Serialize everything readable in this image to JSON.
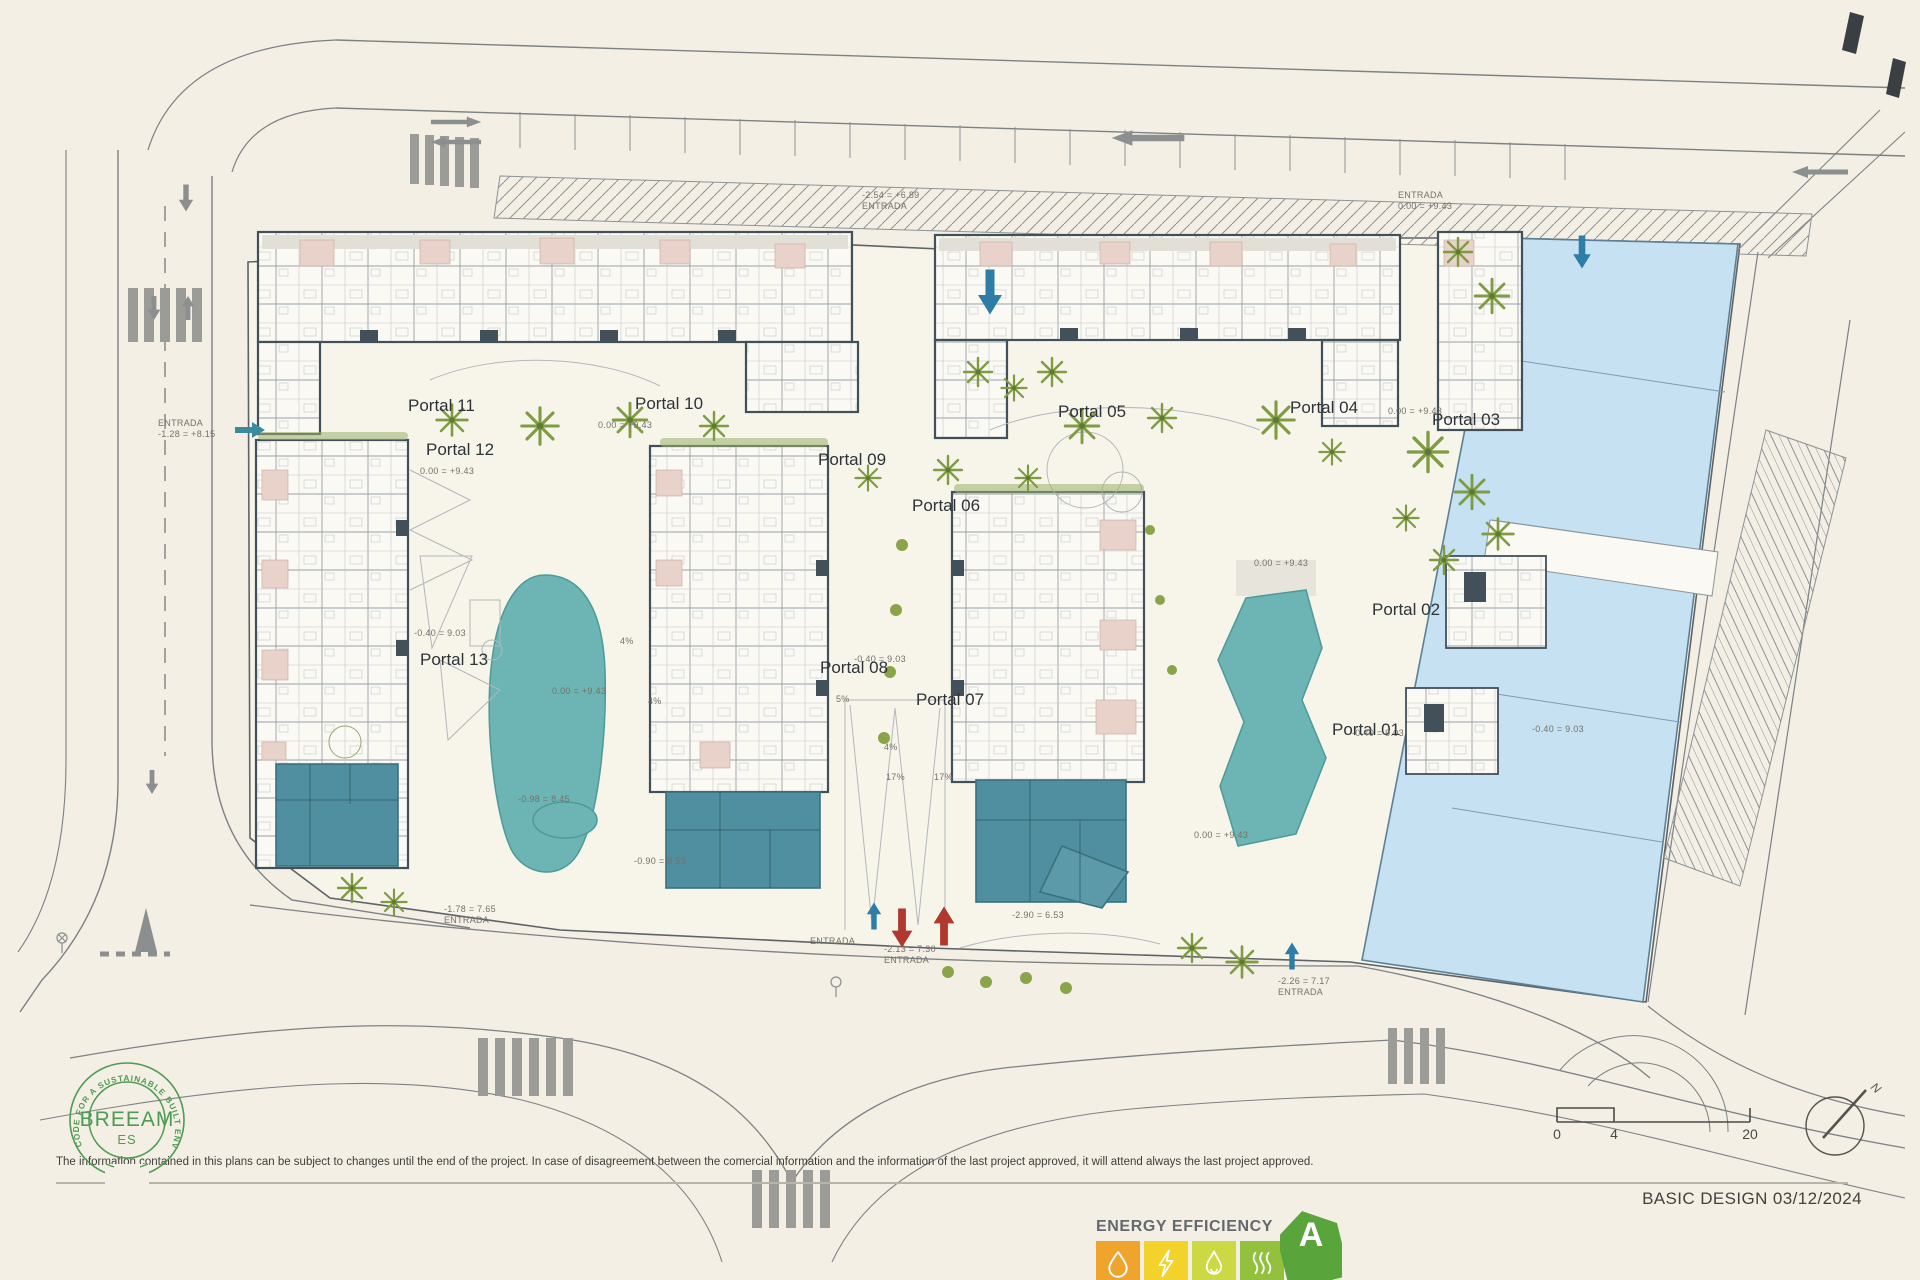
{
  "footer": {
    "disclaimer": "The information contained in this plans can be subject to changes until the end of the project. In case of disagreement between the comercial information and the information of the last project approved, it will attend always the last project approved.",
    "title_block": "BASIC DESIGN 03/12/2024"
  },
  "breeam_logo": {
    "ring_text": "CODE FOR A SUSTAINABLE BUILT ENVIRONMENT",
    "name": "BREEAM",
    "region": "ES",
    "color": "#4f9b53"
  },
  "energy_label": {
    "title": "ENERGY EFFICIENCY",
    "rating": "A",
    "arrow_color": "#5aa43c",
    "cells": [
      {
        "icon": "water-drop-icon",
        "color": "#efa42e"
      },
      {
        "icon": "lightning-icon",
        "color": "#f3d22b"
      },
      {
        "icon": "flame-icon",
        "color": "#cdd944"
      },
      {
        "icon": "heat-waves-icon",
        "color": "#93c13e"
      }
    ]
  },
  "scale_bar": {
    "ticks": [
      "0",
      "4",
      "20"
    ]
  },
  "compass": {
    "label": "N"
  },
  "plan": {
    "colors": {
      "pool": "#6db5b4",
      "ground_floor_block": "#4f8fa0",
      "commercial": "#c5e1f2",
      "vegetation": "#7f9c45",
      "entry_arrow_blue": "#2e7da6",
      "ramp_arrow_red": "#b2372e"
    },
    "portals": [
      {
        "label": "Portal 11",
        "x": 408,
        "y": 396
      },
      {
        "label": "Portal 10",
        "x": 635,
        "y": 394
      },
      {
        "label": "Portal 05",
        "x": 1058,
        "y": 402
      },
      {
        "label": "Portal 04",
        "x": 1290,
        "y": 398
      },
      {
        "label": "Portal 03",
        "x": 1432,
        "y": 410
      },
      {
        "label": "Portal 12",
        "x": 426,
        "y": 440
      },
      {
        "label": "Portal 09",
        "x": 818,
        "y": 450
      },
      {
        "label": "Portal 06",
        "x": 912,
        "y": 496
      },
      {
        "label": "Portal 13",
        "x": 420,
        "y": 650
      },
      {
        "label": "Portal 08",
        "x": 820,
        "y": 658
      },
      {
        "label": "Portal 07",
        "x": 916,
        "y": 690
      },
      {
        "label": "Portal 02",
        "x": 1372,
        "y": 600
      },
      {
        "label": "Portal 01",
        "x": 1332,
        "y": 720
      }
    ],
    "annotations": [
      {
        "x": 862,
        "y": 190,
        "lines": [
          "-2.54 = +6.89",
          "ENTRADA"
        ]
      },
      {
        "x": 1398,
        "y": 190,
        "lines": [
          "ENTRADA",
          "0.00 = +9.43"
        ]
      },
      {
        "x": 158,
        "y": 418,
        "lines": [
          "ENTRADA",
          "-1.28 = +8.15"
        ]
      },
      {
        "x": 598,
        "y": 420,
        "lines": [
          "0.00 = +9.43"
        ]
      },
      {
        "x": 420,
        "y": 466,
        "lines": [
          "0.00 = +9.43"
        ]
      },
      {
        "x": 1388,
        "y": 406,
        "lines": [
          "0.00 = +9.43"
        ]
      },
      {
        "x": 414,
        "y": 628,
        "lines": [
          "-0.40 = 9.03"
        ]
      },
      {
        "x": 552,
        "y": 686,
        "lines": [
          "0.00 = +9.43"
        ]
      },
      {
        "x": 1254,
        "y": 558,
        "lines": [
          "0.00 = +9.43"
        ]
      },
      {
        "x": 1194,
        "y": 830,
        "lines": [
          "0.00 = +9.43"
        ]
      },
      {
        "x": 854,
        "y": 654,
        "lines": [
          "-0.40 = 9.03"
        ]
      },
      {
        "x": 634,
        "y": 856,
        "lines": [
          "-0.90 = 8.53"
        ]
      },
      {
        "x": 518,
        "y": 794,
        "lines": [
          "-0.98 = 8.45"
        ]
      },
      {
        "x": 444,
        "y": 904,
        "lines": [
          "-1.78 = 7.65",
          "ENTRADA"
        ]
      },
      {
        "x": 810,
        "y": 936,
        "lines": [
          "ENTRADA"
        ]
      },
      {
        "x": 884,
        "y": 944,
        "lines": [
          "-2.13 = 7.30",
          "ENTRADA"
        ]
      },
      {
        "x": 1012,
        "y": 910,
        "lines": [
          "-2.90 = 6.53"
        ]
      },
      {
        "x": 1278,
        "y": 976,
        "lines": [
          "-2.26 = 7.17",
          "ENTRADA"
        ]
      },
      {
        "x": 1532,
        "y": 724,
        "lines": [
          "-0.40 = 9.03"
        ]
      },
      {
        "x": 1352,
        "y": 728,
        "lines": [
          "-0.40 = 9.03"
        ]
      },
      {
        "x": 620,
        "y": 636,
        "lines": [
          "4%"
        ]
      },
      {
        "x": 648,
        "y": 696,
        "lines": [
          "4%"
        ]
      },
      {
        "x": 884,
        "y": 742,
        "lines": [
          "4%"
        ]
      },
      {
        "x": 836,
        "y": 694,
        "lines": [
          "5%"
        ]
      },
      {
        "x": 886,
        "y": 772,
        "lines": [
          "17%"
        ]
      },
      {
        "x": 934,
        "y": 772,
        "lines": [
          "17%"
        ]
      }
    ],
    "arrows": [
      {
        "kind": "block",
        "dir": "down",
        "color": "#2e7da6",
        "x": 990,
        "y": 292,
        "s": 1.5
      },
      {
        "kind": "block",
        "dir": "down",
        "color": "#2e7da6",
        "x": 1582,
        "y": 252,
        "s": 1.1
      },
      {
        "kind": "block",
        "dir": "right",
        "color": "#3a8ba0",
        "x": 250,
        "y": 430,
        "s": 1.0
      },
      {
        "kind": "block",
        "dir": "up",
        "color": "#2e7da6",
        "x": 874,
        "y": 916,
        "s": 0.9
      },
      {
        "kind": "block",
        "dir": "down",
        "color": "#b2372e",
        "x": 902,
        "y": 928,
        "s": 1.3
      },
      {
        "kind": "block",
        "dir": "up",
        "color": "#b2372e",
        "x": 944,
        "y": 926,
        "s": 1.3
      },
      {
        "kind": "block",
        "dir": "up",
        "color": "#2e7da6",
        "x": 1292,
        "y": 956,
        "s": 0.9
      },
      {
        "kind": "lane",
        "dir": "left",
        "color": "#8c8f90",
        "x": 1148,
        "y": 138,
        "s": 1.3
      },
      {
        "kind": "lane",
        "dir": "left",
        "color": "#8c8f90",
        "x": 1820,
        "y": 172,
        "s": 1.0
      },
      {
        "kind": "lane",
        "dir": "right",
        "color": "#8c8f90",
        "x": 456,
        "y": 122,
        "s": 0.9
      },
      {
        "kind": "lane",
        "dir": "left",
        "color": "#8c8f90",
        "x": 456,
        "y": 142,
        "s": 0.9
      },
      {
        "kind": "block",
        "dir": "down",
        "color": "#8c8f90",
        "x": 186,
        "y": 198,
        "s": 0.9
      },
      {
        "kind": "block",
        "dir": "down",
        "color": "#8c8f90",
        "x": 154,
        "y": 308,
        "s": 0.8
      },
      {
        "kind": "block",
        "dir": "up",
        "color": "#8c8f90",
        "x": 188,
        "y": 308,
        "s": 0.8
      },
      {
        "kind": "block",
        "dir": "down",
        "color": "#8c8f90",
        "x": 152,
        "y": 782,
        "s": 0.8
      }
    ]
  }
}
